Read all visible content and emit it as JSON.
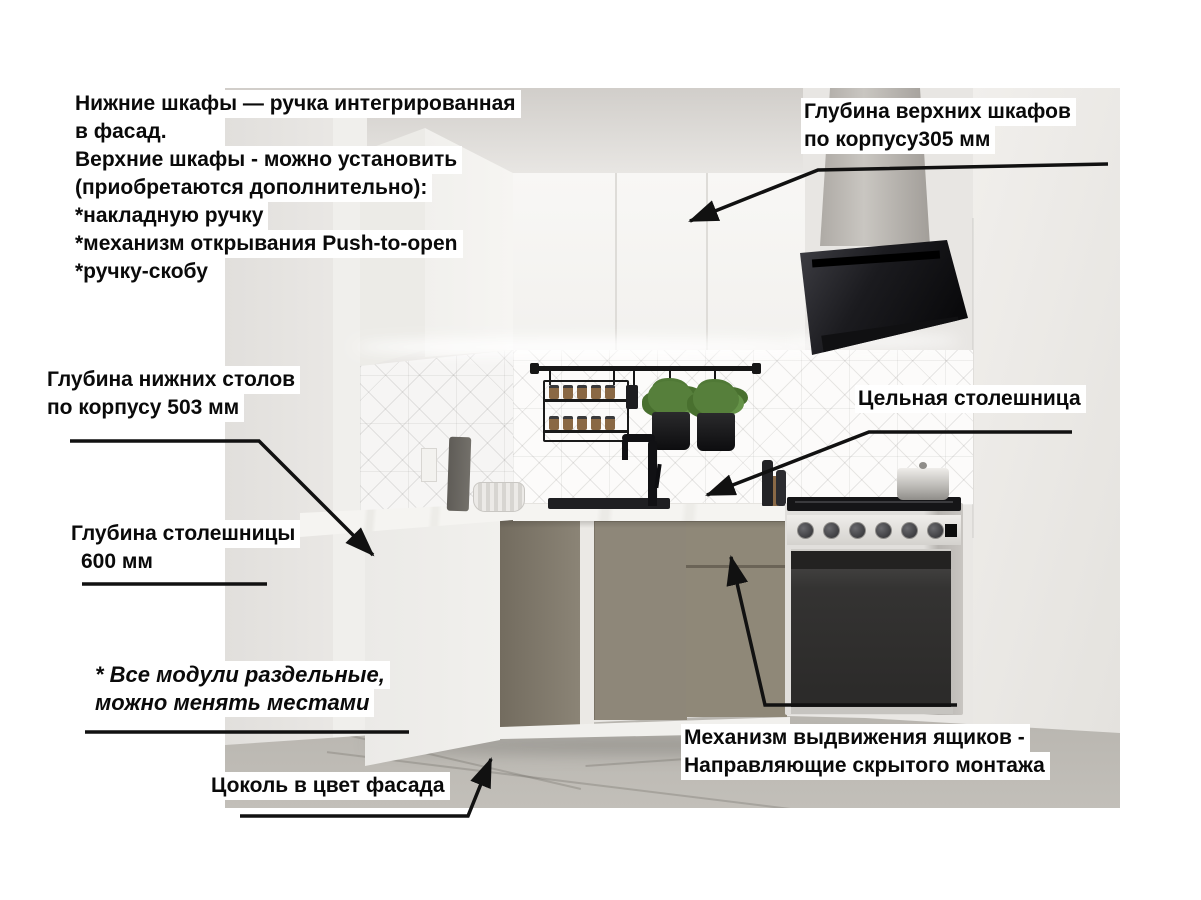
{
  "annotations": {
    "top_left": {
      "lines": [
        "Нижние шкафы — ручка интегрированная",
        "в фасад.",
        "Верхние шкафы - можно установить",
        "(приобретаются дополнительно):",
        "*накладную ручку",
        "*механизм открывания Push-to-open",
        "*ручку-скобу"
      ]
    },
    "upper_depth": {
      "lines": [
        "Глубина верхних шкафов",
        "по корпусу305 мм"
      ]
    },
    "base_depth": {
      "lines": [
        "Глубина нижних столов",
        "по корпусу 503 мм"
      ]
    },
    "counter_depth": {
      "lines": [
        "Глубина столешницы",
        "600 мм"
      ]
    },
    "solid_counter": {
      "text": "Цельная столешница"
    },
    "modules_note": {
      "lines": [
        "* Все модули раздельные,",
        "можно менять местами"
      ]
    },
    "plinth": {
      "text": "Цоколь в цвет фасада"
    },
    "drawers": {
      "lines": [
        "Механизм выдвижения ящиков -",
        "Направляющие скрытого монтажа"
      ]
    }
  },
  "colors": {
    "page_bg": "#ffffff",
    "label_bg": "#ffffff",
    "text": "#0a0a0a",
    "pointer": "#111111",
    "wall_left": "#e6e4e1",
    "wall_right": "#edebe8",
    "ceiling": "#d8d5d1",
    "upper_cabinet": "#f6f5f2",
    "backsplash": "#fbfaf9",
    "countertop": "#f3f2ef",
    "base_cabinet": "#8e8779",
    "end_panel": "#efeeeb",
    "plinth": "#f1f0ed",
    "hood": "#141416",
    "chimney": "#bbb7b2",
    "floor": "#b9b6b0",
    "oven": "#3f3e3e",
    "stove_body": "#d9d7d4",
    "rail": "#161616",
    "plant": "#567f3b"
  }
}
